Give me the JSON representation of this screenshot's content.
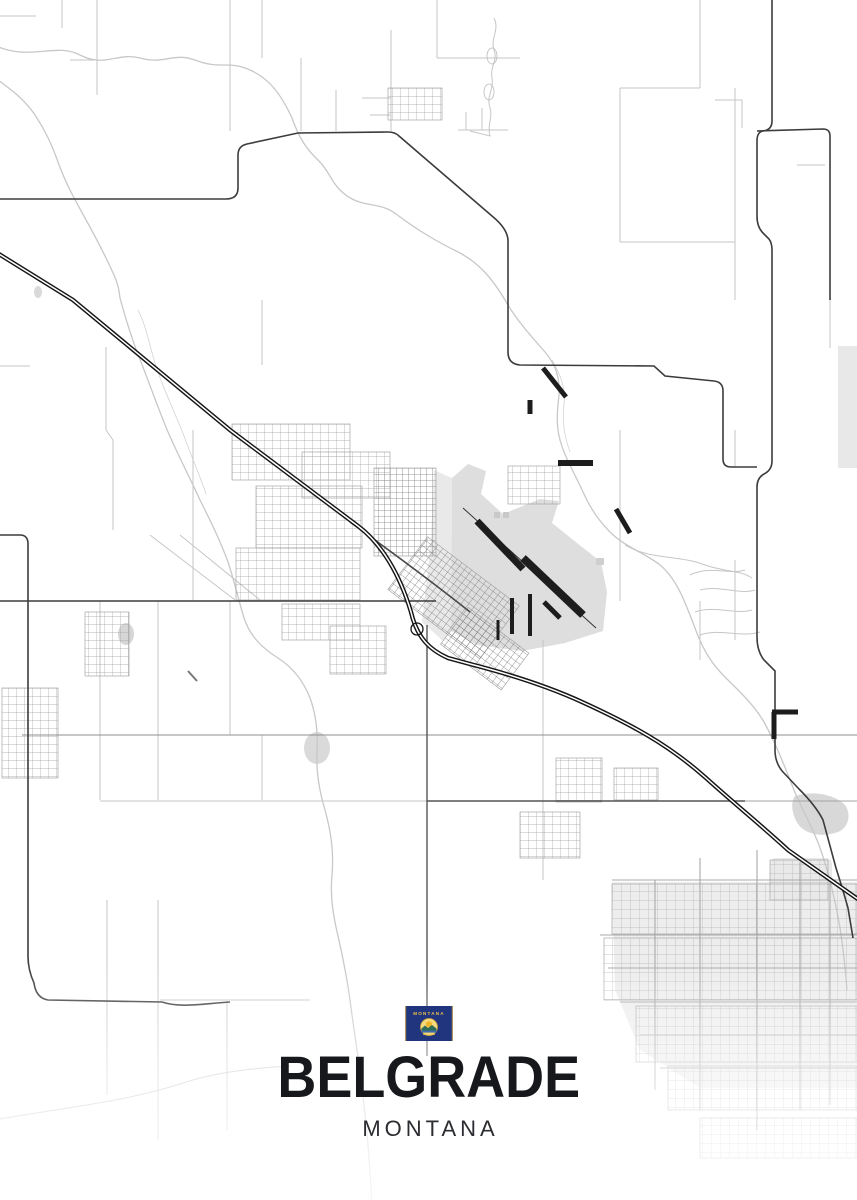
{
  "poster": {
    "title": "BELGRADE",
    "subtitle": "MONTANA",
    "flag": {
      "text": "MONTANA"
    },
    "colors": {
      "background": "#ffffff",
      "title_text": "#17181b",
      "subtitle_text": "#2b2d31",
      "road_minor": "#c6c6c6",
      "road_medium": "#8f8f8f",
      "road_major": "#3c3c3c",
      "interstate": "#161616",
      "water": "#c7c9c6",
      "urban_area": "#e6e6e6",
      "runway": "#1d1d1d",
      "flag_field": "#20357e",
      "flag_gold": "#f0c04a"
    },
    "map_features": [
      "interstate-highway-diagonal",
      "airport-runways",
      "town-street-grid",
      "meandering-rivers",
      "rural-section-roads",
      "southeast-suburb-grid"
    ]
  }
}
